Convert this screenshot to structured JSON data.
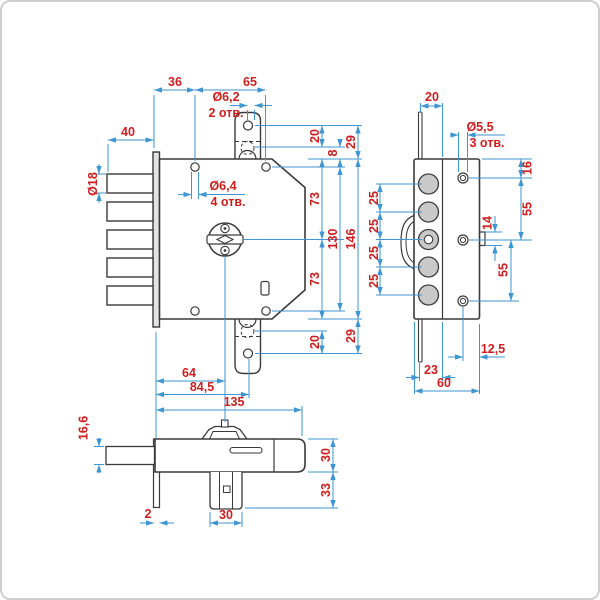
{
  "drawing": {
    "canvas": {
      "width": 600,
      "height": 600
    },
    "colors": {
      "line": "#3a3a3a",
      "dimension": "#3e96d2",
      "label": "#ce1e1e",
      "bolt_fill": "#c9c9c9"
    },
    "dims": {
      "front": {
        "plate_to_holes": "36",
        "hole_span_h": "65",
        "tab_hole_dia": "Ø6,2",
        "tab_hole_qty": "2 отв.",
        "bolt_throw": "40",
        "bolt_dia": "Ø18",
        "corner_hole_dia": "Ø6,4",
        "corner_hole_qty": "4 отв.",
        "tab_hole_top": "20",
        "edge_top": "8",
        "tab_overhang_top": "29",
        "upper_half": "73",
        "lower_half": "73",
        "hole_span_v": "130",
        "body_height": "146",
        "tab_hole_bottom": "20",
        "tab_overhang_bottom": "29"
      },
      "side": {
        "rod_offset": "20",
        "face_hole_dia": "Ø5,5",
        "face_hole_qty": "3 отв.",
        "top_hole_offset": "16",
        "upper_hole_spacing": "55",
        "stop_height": "14",
        "lower_hole_spacing": "55",
        "bolt_pitch": [
          "25",
          "25",
          "25",
          "25"
        ],
        "hole_edge_offset": "12,5",
        "rod_inset": "23",
        "body_depth": "60"
      },
      "bottom": {
        "cylinder_offset": "64",
        "tab_hole_offset": "84,5",
        "body_width": "135",
        "bolt_height": "16,6",
        "case_depth": "30",
        "cylinder_depth": "33",
        "plate_thickness": "2",
        "cylinder_width": "30"
      }
    }
  }
}
